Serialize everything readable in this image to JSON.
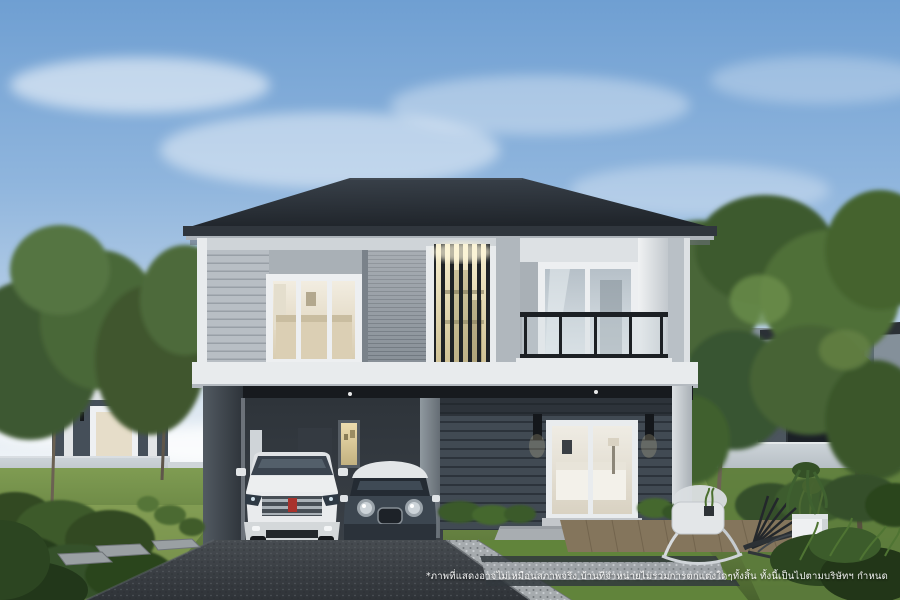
{
  "meta": {
    "width": 900,
    "height": 600,
    "kind": "architectural-rendering-photo"
  },
  "scene": {
    "description": "3D rendering of a modern two-storey detached house with dark hipped roof, grey horizontal siding, warm-lit vertical-slat feature wall, glass balcony, carport with a white SUV and a dark compact car, landscaped front yard with driveway, gravel and grass strips, designer lounge chairs, white planter, neighbouring houses, trees and partly cloudy blue sky"
  },
  "footer": {
    "disclaimer": "*ภาพที่แสดงอาจไม่เหมือนสภาพจริง บ้านที่จำหน่ายไม่รวมการตกแต่งใดๆทั้งสิ้น ทั้งนี้เป็นไปตามบริษัทฯ กำหนด"
  },
  "colors": {
    "sky_top": "#6f9fd2",
    "sky_horizon": "#e7edf1",
    "roof": "#272c33",
    "trim_white": "#e8ebed",
    "siding_light": "#b8bec4",
    "wall_dark": "#414a53",
    "warm_light": "#e6d9ae",
    "lawn_green": "#6c8a47",
    "hedge_green": "#3c5427",
    "driveway_asphalt": "#3a3f44",
    "gravel": "#a6abae",
    "deck_wood": "#84755c",
    "car_suv_white": "#e9ebed",
    "car_mini_dark": "#3c4650",
    "car_mini_roof": "#e3e6e8",
    "railing_black": "#1c2024",
    "badge_red": "#a8322c",
    "disclaimer_text": "#ffffff"
  }
}
